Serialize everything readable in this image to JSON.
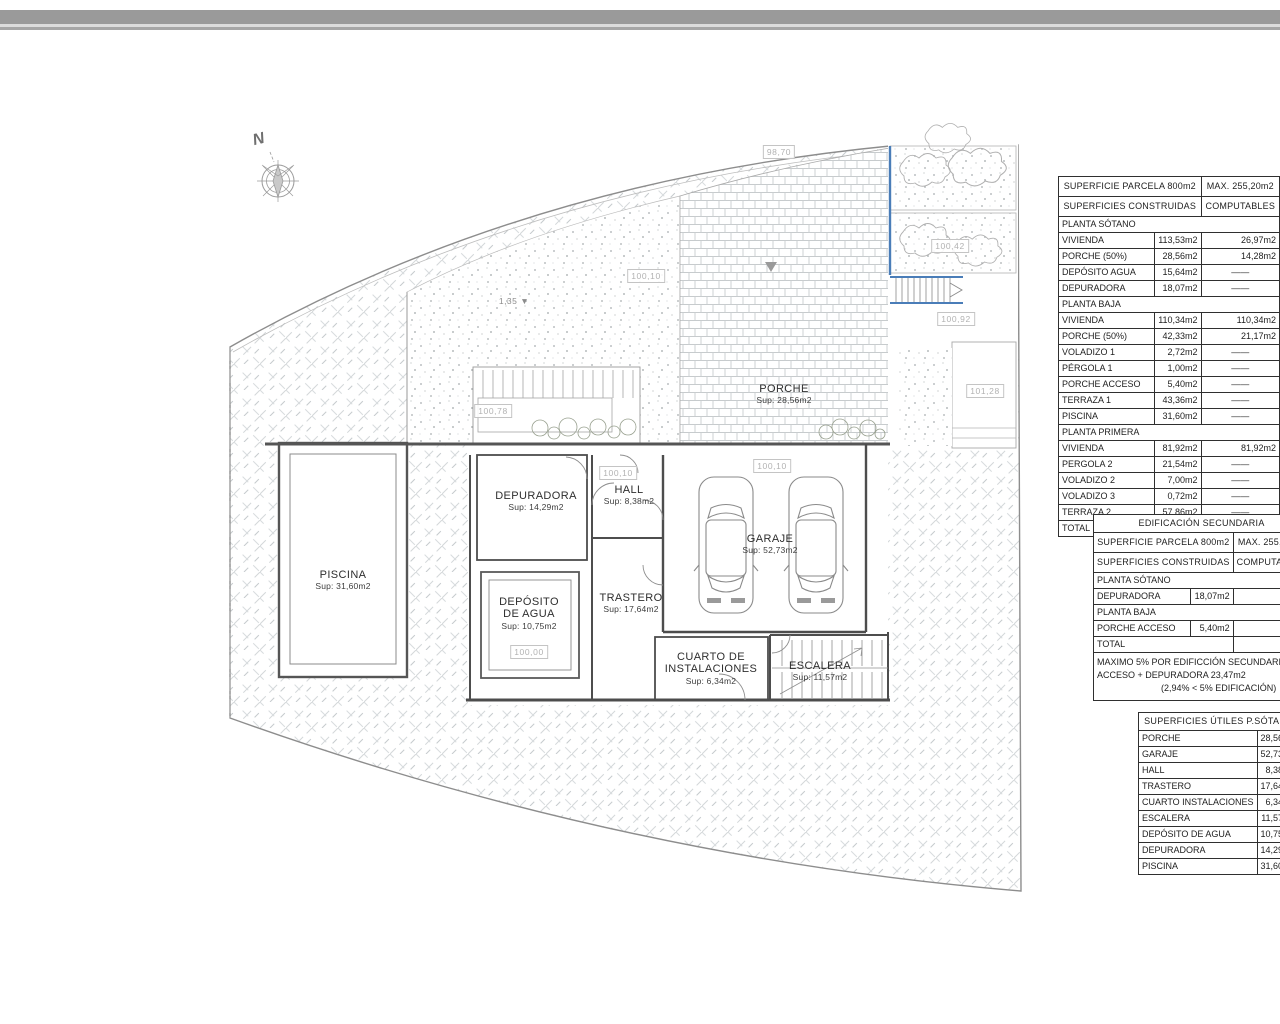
{
  "plan": {
    "north_label": "N",
    "slope_marker": "1,35 ▼",
    "rooms": [
      {
        "name": "PISCINA",
        "sup": "Sup: 31,60m2",
        "x": 343,
        "y": 569
      },
      {
        "name": "DEPURADORA",
        "sup": "Sup: 14,29m2",
        "x": 536,
        "y": 490
      },
      {
        "name": "DEPÓSITO\nDE AGUA",
        "sup": "Sup: 10,75m2",
        "x": 529,
        "y": 596
      },
      {
        "name": "HALL",
        "sup": "Sup: 8,38m2",
        "x": 629,
        "y": 484
      },
      {
        "name": "TRASTERO",
        "sup": "Sup: 17,64m2",
        "x": 631,
        "y": 592
      },
      {
        "name": "GARAJE",
        "sup": "Sup: 52,73m2",
        "x": 770,
        "y": 533
      },
      {
        "name": "CUARTO DE\nINSTALACIONES",
        "sup": "Sup: 6,34m2",
        "x": 711,
        "y": 651
      },
      {
        "name": "ESCALERA",
        "sup": "Sup: 11,57m2",
        "x": 820,
        "y": 660
      },
      {
        "name": "PORCHE",
        "sup": "Sup: 28,56m2",
        "x": 784,
        "y": 383
      }
    ],
    "level_markers": [
      {
        "text": "98,70",
        "x": 779,
        "y": 152
      },
      {
        "text": "100,10",
        "x": 646,
        "y": 276
      },
      {
        "text": "100,42",
        "x": 950,
        "y": 246
      },
      {
        "text": "100,92",
        "x": 956,
        "y": 319
      },
      {
        "text": "101,28",
        "x": 985,
        "y": 391
      },
      {
        "text": "100,78",
        "x": 493,
        "y": 411
      },
      {
        "text": "100,10",
        "x": 618,
        "y": 473
      },
      {
        "text": "100,10",
        "x": 772,
        "y": 466
      },
      {
        "text": "100,00",
        "x": 529,
        "y": 652
      }
    ]
  },
  "tables": {
    "main": {
      "headers": [
        {
          "left": "SUPERFICIE PARCELA 800m2",
          "right": "MAX. 255,20m2"
        },
        {
          "left": "SUPERFICIES CONSTRUIDAS",
          "right": "COMPUTABLES"
        }
      ],
      "rows": [
        {
          "type": "section",
          "label": "PLANTA SÓTANO"
        },
        {
          "type": "data",
          "label": "VIVIENDA",
          "built": "113,53m2",
          "comp": "26,97m2"
        },
        {
          "type": "data",
          "label": "PORCHE (50%)",
          "built": "28,56m2",
          "comp": "14,28m2"
        },
        {
          "type": "data",
          "label": "DEPÓSITO AGUA",
          "built": "15,64m2",
          "comp": "——"
        },
        {
          "type": "data",
          "label": "DEPURADORA",
          "built": "18,07m2",
          "comp": "——"
        },
        {
          "type": "section",
          "label": "PLANTA BAJA"
        },
        {
          "type": "data",
          "label": "VIVIENDA",
          "built": "110,34m2",
          "comp": "110,34m2"
        },
        {
          "type": "data",
          "label": "PORCHE (50%)",
          "built": "42,33m2",
          "comp": "21,17m2"
        },
        {
          "type": "data",
          "label": "VOLADIZO 1",
          "built": "2,72m2",
          "comp": "——"
        },
        {
          "type": "data",
          "label": "PÉRGOLA 1",
          "built": "1,00m2",
          "comp": "——"
        },
        {
          "type": "data",
          "label": "PORCHE ACCESO",
          "built": "5,40m2",
          "comp": "——"
        },
        {
          "type": "data",
          "label": "TERRAZA 1",
          "built": "43,36m2",
          "comp": "——"
        },
        {
          "type": "data",
          "label": "PISCINA",
          "built": "31,60m2",
          "comp": "——"
        },
        {
          "type": "section",
          "label": "PLANTA PRIMERA"
        },
        {
          "type": "data",
          "label": "VIVIENDA",
          "built": "81,92m2",
          "comp": "81,92m2"
        },
        {
          "type": "data",
          "label": "PERGOLA 2",
          "built": "21,54m2",
          "comp": "——"
        },
        {
          "type": "data",
          "label": "VOLADIZO 2",
          "built": "7,00m2",
          "comp": "——"
        },
        {
          "type": "data",
          "label": "VOLADIZO 3",
          "built": "0,72m2",
          "comp": "——"
        },
        {
          "type": "data",
          "label": "TERRAZA 2",
          "built": "57,86m2",
          "comp": "——"
        },
        {
          "type": "total",
          "label": "TOTAL",
          "comp": "254,68m2"
        }
      ]
    },
    "secondary": {
      "title": "EDIFICACIÓN SECUNDARIA",
      "headers": [
        {
          "left": "SUPERFICIE PARCELA 800m2",
          "right": "MAX. 255,20m2"
        },
        {
          "left": "SUPERFICIES CONSTRUIDAS",
          "right": "COMPUTABLES"
        }
      ],
      "rows": [
        {
          "type": "section",
          "label": "PLANTA SÓTANO"
        },
        {
          "type": "data",
          "label": "DEPURADORA",
          "built": "18,07m2",
          "comp": ""
        },
        {
          "type": "section",
          "label": "PLANTA BAJA"
        },
        {
          "type": "data",
          "label": "PORCHE ACCESO",
          "built": "5,40m2",
          "comp": ""
        },
        {
          "type": "total",
          "label": "TOTAL",
          "comp": ""
        }
      ],
      "notes": [
        "MAXIMO 5% POR EDIFICCIÓN SECUNDARIA",
        "ACCESO + DEPURADORA   23,47m2",
        "(2,94% < 5% EDIFICACIÓN)"
      ]
    },
    "useful": {
      "title": "SUPERFICIES ÚTILES P.SÓTANO",
      "rows": [
        {
          "label": "PORCHE",
          "value": "28,56m2"
        },
        {
          "label": "GARAJE",
          "value": "52,73m2"
        },
        {
          "label": "HALL",
          "value": "8,38m2"
        },
        {
          "label": "TRASTERO",
          "value": "17,64m2"
        },
        {
          "label": "CUARTO INSTALACIONES",
          "value": "6,34m2"
        },
        {
          "label": "ESCALERA",
          "value": "11,57m2"
        },
        {
          "label": "DEPÓSITO DE AGUA",
          "value": "10,75m2"
        },
        {
          "label": "DEPURADORA",
          "value": "14,29m2"
        },
        {
          "label": "PISCINA",
          "value": "31,60m2"
        }
      ]
    }
  }
}
